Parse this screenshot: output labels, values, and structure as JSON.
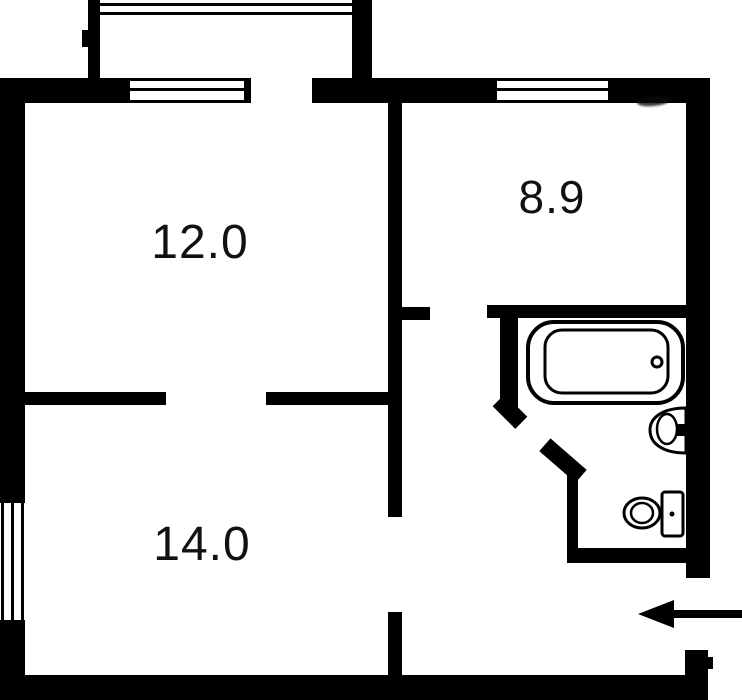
{
  "plan": {
    "type": "apartment-floor-plan",
    "rooms": [
      {
        "name": "room-12",
        "label": "12.0"
      },
      {
        "name": "room-8-9",
        "label": "8.9"
      },
      {
        "name": "room-14",
        "label": "14.0"
      }
    ],
    "fixtures": [
      "bathtub",
      "sink",
      "toilet"
    ],
    "features": [
      "balcony",
      "entrance-arrow",
      "window-top-left",
      "window-top-right",
      "window-left"
    ],
    "colors": {
      "wall": "#000000",
      "background": "#ffffff",
      "label_text": "#111111"
    }
  }
}
